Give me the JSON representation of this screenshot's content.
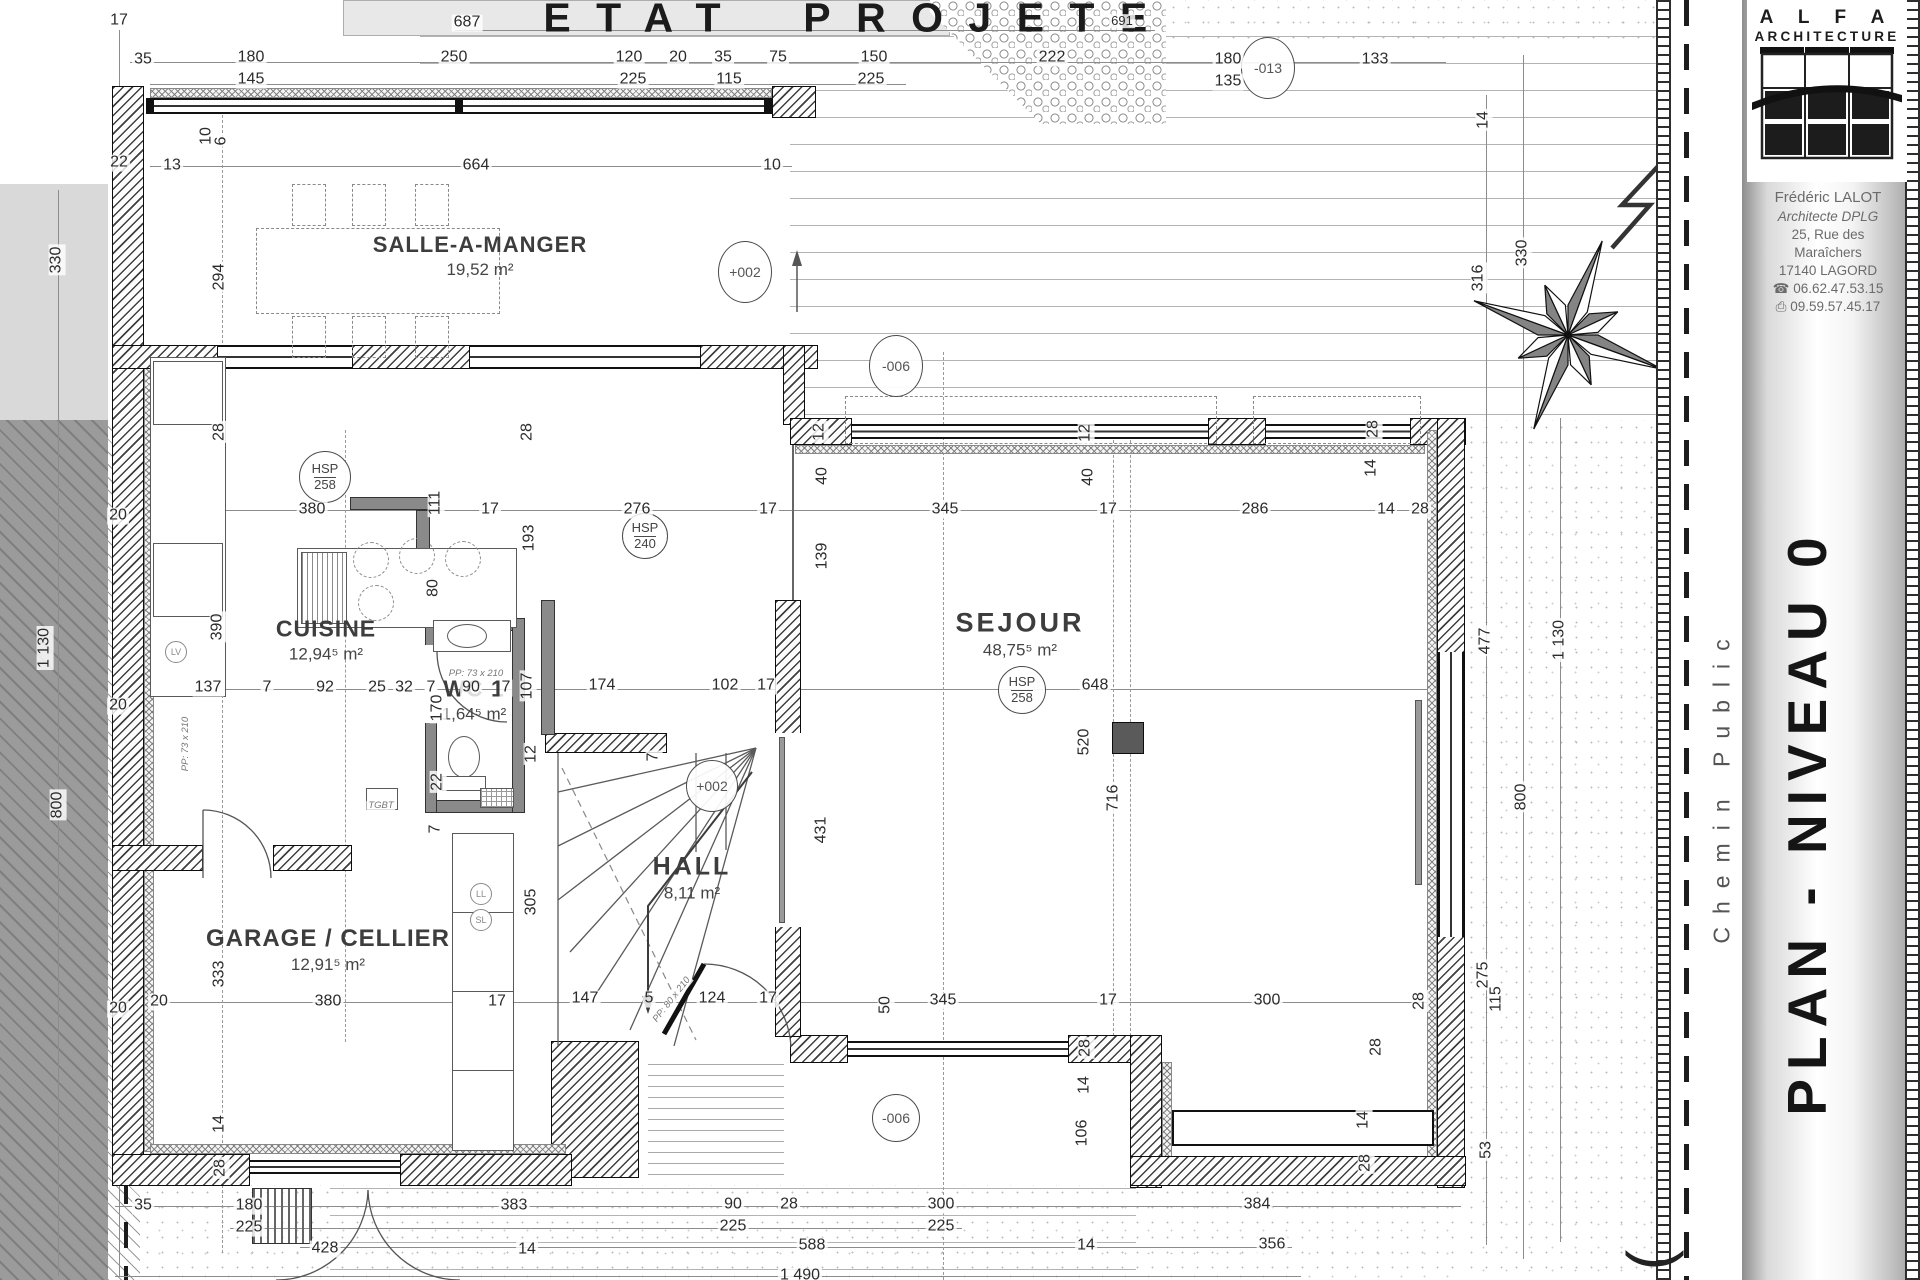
{
  "title": "ETAT PROJETE",
  "sidebar": {
    "brand_top": "A L F A",
    "brand_bottom": "ARCHITECTURE",
    "architect": "Frédéric LALOT",
    "credential": "Architecte DPLG",
    "address_line1": "25, Rue des",
    "address_line2": "Maraîchers",
    "address_line3": "17140 LAGORD",
    "phone": "06.62.47.53.15",
    "fax": "09.59.57.45.17",
    "icons": {
      "phone": "☎",
      "fax": "⎙"
    },
    "plan_title": "PLAN - NIVEAU 0",
    "street_label": "Chemin Public",
    "corner_glyph": "("
  },
  "rooms": [
    {
      "name": "SALLE-A-MANGER",
      "area": "19,52 m²",
      "cx": 480,
      "cy": 256
    },
    {
      "name": "CUISINE",
      "area": "12,94⁵ m²",
      "cx": 326,
      "cy": 640
    },
    {
      "name": "WC 1",
      "area": "1,64⁵ m²",
      "cx": 474,
      "cy": 700
    },
    {
      "name": "HALL",
      "area": "8,11 m²",
      "cx": 692,
      "cy": 878
    },
    {
      "name": "SEJOUR",
      "area": "48,75⁵ m²",
      "cx": 1020,
      "cy": 634
    },
    {
      "name": "GARAGE / CELLIER",
      "area": "12,91⁵ m²",
      "cx": 328,
      "cy": 950
    }
  ],
  "markers": [
    {
      "kind": "level",
      "label": "+002",
      "x": 745,
      "y": 272,
      "w": 52,
      "h": 60
    },
    {
      "kind": "level",
      "label": "+002",
      "x": 712,
      "y": 786,
      "w": 50,
      "h": 50
    },
    {
      "kind": "level",
      "label": "-006",
      "x": 896,
      "y": 366,
      "w": 52,
      "h": 60
    },
    {
      "kind": "level",
      "label": "-006",
      "x": 896,
      "y": 1118,
      "w": 46,
      "h": 46
    },
    {
      "kind": "level",
      "label": "-013",
      "x": 1268,
      "y": 68,
      "w": 52,
      "h": 60
    },
    {
      "kind": "hsp",
      "top": "HSP",
      "bottom": "258",
      "x": 325,
      "y": 477,
      "d": 50
    },
    {
      "kind": "hsp",
      "top": "HSP",
      "bottom": "240",
      "x": 645,
      "y": 536,
      "d": 44
    },
    {
      "kind": "hsp",
      "top": "HSP",
      "bottom": "258",
      "x": 1022,
      "y": 690,
      "d": 46
    },
    {
      "kind": "mini",
      "label": "LL",
      "x": 481,
      "y": 894,
      "d": 20
    },
    {
      "kind": "mini",
      "label": "SL",
      "x": 481,
      "y": 920,
      "d": 20
    },
    {
      "kind": "mini",
      "label": "LV",
      "x": 176,
      "y": 652,
      "d": 20
    }
  ],
  "annotations": [
    {
      "t": "17",
      "x": 119,
      "y": 21
    },
    {
      "t": "687",
      "x": 467,
      "y": 23
    },
    {
      "t": "691",
      "x": 1122,
      "y": 21,
      "s": "s"
    },
    {
      "t": "35",
      "x": 143,
      "y": 60
    },
    {
      "t": "180",
      "x": 251,
      "y": 58
    },
    {
      "t": "145",
      "x": 251,
      "y": 80
    },
    {
      "t": "250",
      "x": 454,
      "y": 58
    },
    {
      "t": "120",
      "x": 629,
      "y": 58
    },
    {
      "t": "225",
      "x": 633,
      "y": 80
    },
    {
      "t": "20",
      "x": 678,
      "y": 58
    },
    {
      "t": "35",
      "x": 723,
      "y": 58
    },
    {
      "t": "115",
      "x": 729,
      "y": 80
    },
    {
      "t": "75",
      "x": 778,
      "y": 58
    },
    {
      "t": "150",
      "x": 874,
      "y": 58
    },
    {
      "t": "225",
      "x": 871,
      "y": 80
    },
    {
      "t": "222",
      "x": 1052,
      "y": 58
    },
    {
      "t": "180",
      "x": 1228,
      "y": 60
    },
    {
      "t": "135",
      "x": 1228,
      "y": 82
    },
    {
      "t": "133",
      "x": 1375,
      "y": 60
    },
    {
      "t": "22",
      "x": 119,
      "y": 163
    },
    {
      "t": "13",
      "x": 172,
      "y": 166
    },
    {
      "t": "664",
      "x": 476,
      "y": 166
    },
    {
      "t": "10",
      "x": 772,
      "y": 166
    },
    {
      "t": "10",
      "x": 207,
      "y": 136,
      "r": -90
    },
    {
      "t": "6",
      "x": 222,
      "y": 141,
      "r": -90
    },
    {
      "t": "294",
      "x": 220,
      "y": 277,
      "r": -90
    },
    {
      "t": "14",
      "x": 1484,
      "y": 120,
      "r": -90
    },
    {
      "t": "316",
      "x": 1479,
      "y": 278,
      "r": -90
    },
    {
      "t": "330",
      "x": 1523,
      "y": 253,
      "r": -90
    },
    {
      "t": "330",
      "x": 57,
      "y": 260,
      "r": -90
    },
    {
      "t": "28",
      "x": 220,
      "y": 432,
      "r": -90
    },
    {
      "t": "28",
      "x": 528,
      "y": 432,
      "r": -90
    },
    {
      "t": "12",
      "x": 820,
      "y": 432,
      "r": -90
    },
    {
      "t": "40",
      "x": 823,
      "y": 476,
      "r": -90
    },
    {
      "t": "12",
      "x": 1086,
      "y": 433,
      "r": -90
    },
    {
      "t": "40",
      "x": 1089,
      "y": 477,
      "r": -90
    },
    {
      "t": "28",
      "x": 1374,
      "y": 429,
      "r": -90
    },
    {
      "t": "14",
      "x": 1372,
      "y": 468,
      "r": -90
    },
    {
      "t": "380",
      "x": 312,
      "y": 510
    },
    {
      "t": "111",
      "x": 436,
      "y": 503,
      "r": -90
    },
    {
      "t": "17",
      "x": 490,
      "y": 510
    },
    {
      "t": "276",
      "x": 637,
      "y": 510
    },
    {
      "t": "193",
      "x": 530,
      "y": 538,
      "r": -90
    },
    {
      "t": "17",
      "x": 768,
      "y": 510
    },
    {
      "t": "345",
      "x": 945,
      "y": 510
    },
    {
      "t": "139",
      "x": 823,
      "y": 556,
      "r": -90
    },
    {
      "t": "17",
      "x": 1108,
      "y": 510
    },
    {
      "t": "286",
      "x": 1255,
      "y": 510
    },
    {
      "t": "14",
      "x": 1386,
      "y": 510
    },
    {
      "t": "28",
      "x": 1420,
      "y": 510
    },
    {
      "t": "390",
      "x": 218,
      "y": 627,
      "r": -90
    },
    {
      "t": "80",
      "x": 434,
      "y": 588,
      "r": -90
    },
    {
      "t": "137",
      "x": 208,
      "y": 688
    },
    {
      "t": "7",
      "x": 267,
      "y": 688
    },
    {
      "t": "92",
      "x": 325,
      "y": 688
    },
    {
      "t": "25",
      "x": 377,
      "y": 688
    },
    {
      "t": "32",
      "x": 404,
      "y": 688
    },
    {
      "t": "7",
      "x": 431,
      "y": 688
    },
    {
      "t": "90",
      "x": 471,
      "y": 688
    },
    {
      "t": "7",
      "x": 506,
      "y": 688
    },
    {
      "t": "107",
      "x": 528,
      "y": 686,
      "r": -90
    },
    {
      "t": "174",
      "x": 602,
      "y": 686
    },
    {
      "t": "102",
      "x": 725,
      "y": 686
    },
    {
      "t": "17",
      "x": 766,
      "y": 686
    },
    {
      "t": "170",
      "x": 438,
      "y": 708,
      "r": -90
    },
    {
      "t": "22",
      "x": 438,
      "y": 782,
      "r": -90
    },
    {
      "t": "7",
      "x": 436,
      "y": 829,
      "r": -90
    },
    {
      "t": "7",
      "x": 654,
      "y": 757,
      "r": -90
    },
    {
      "t": "648",
      "x": 1095,
      "y": 686
    },
    {
      "t": "520",
      "x": 1085,
      "y": 742,
      "r": -90
    },
    {
      "t": "431",
      "x": 822,
      "y": 830,
      "r": -90
    },
    {
      "t": "12",
      "x": 532,
      "y": 754,
      "r": -90
    },
    {
      "t": "305",
      "x": 532,
      "y": 902,
      "r": -90
    },
    {
      "t": "716",
      "x": 1114,
      "y": 798,
      "r": -90
    },
    {
      "t": "147",
      "x": 585,
      "y": 999
    },
    {
      "t": "5",
      "x": 649,
      "y": 999
    },
    {
      "t": "124",
      "x": 712,
      "y": 999
    },
    {
      "t": "17",
      "x": 768,
      "y": 999
    },
    {
      "t": "345",
      "x": 943,
      "y": 1001
    },
    {
      "t": "17",
      "x": 1108,
      "y": 1001
    },
    {
      "t": "300",
      "x": 1267,
      "y": 1001
    },
    {
      "t": "28",
      "x": 1420,
      "y": 1001,
      "r": -90
    },
    {
      "t": "50",
      "x": 886,
      "y": 1005,
      "r": -90
    },
    {
      "t": "477",
      "x": 1486,
      "y": 641,
      "r": -90
    },
    {
      "t": "1 130",
      "x": 1560,
      "y": 640,
      "r": -90
    },
    {
      "t": "800",
      "x": 1522,
      "y": 797,
      "r": -90
    },
    {
      "t": "1 130",
      "x": 45,
      "y": 648,
      "r": -90
    },
    {
      "t": "800",
      "x": 58,
      "y": 805,
      "r": -90
    },
    {
      "t": "20",
      "x": 118,
      "y": 516
    },
    {
      "t": "20",
      "x": 118,
      "y": 706
    },
    {
      "t": "20",
      "x": 118,
      "y": 1009
    },
    {
      "t": "275",
      "x": 1484,
      "y": 975,
      "r": -90
    },
    {
      "t": "115",
      "x": 1497,
      "y": 999,
      "r": -90
    },
    {
      "t": "53",
      "x": 1487,
      "y": 1150,
      "r": -90
    },
    {
      "t": "20",
      "x": 159,
      "y": 1002
    },
    {
      "t": "333",
      "x": 220,
      "y": 974,
      "r": -90
    },
    {
      "t": "380",
      "x": 328,
      "y": 1002
    },
    {
      "t": "17",
      "x": 497,
      "y": 1002
    },
    {
      "t": "14",
      "x": 220,
      "y": 1124,
      "r": -90
    },
    {
      "t": "28",
      "x": 221,
      "y": 1168,
      "r": -90
    },
    {
      "t": "35",
      "x": 143,
      "y": 1206
    },
    {
      "t": "180",
      "x": 249,
      "y": 1206
    },
    {
      "t": "225",
      "x": 249,
      "y": 1228
    },
    {
      "t": "428",
      "x": 325,
      "y": 1249
    },
    {
      "t": "383",
      "x": 514,
      "y": 1206
    },
    {
      "t": "14",
      "x": 527,
      "y": 1250
    },
    {
      "t": "90",
      "x": 733,
      "y": 1205
    },
    {
      "t": "225",
      "x": 733,
      "y": 1227
    },
    {
      "t": "28",
      "x": 789,
      "y": 1205
    },
    {
      "t": "300",
      "x": 941,
      "y": 1205
    },
    {
      "t": "225",
      "x": 941,
      "y": 1227
    },
    {
      "t": "588",
      "x": 812,
      "y": 1246
    },
    {
      "t": "14",
      "x": 1086,
      "y": 1246
    },
    {
      "t": "384",
      "x": 1257,
      "y": 1205
    },
    {
      "t": "356",
      "x": 1272,
      "y": 1245
    },
    {
      "t": "28",
      "x": 1086,
      "y": 1048,
      "r": -90
    },
    {
      "t": "14",
      "x": 1085,
      "y": 1085,
      "r": -90
    },
    {
      "t": "106",
      "x": 1083,
      "y": 1133,
      "r": -90
    },
    {
      "t": "14",
      "x": 1364,
      "y": 1120,
      "r": -90
    },
    {
      "t": "28",
      "x": 1366,
      "y": 1163,
      "r": -90
    },
    {
      "t": "28",
      "x": 1377,
      "y": 1047,
      "r": -90
    },
    {
      "t": "1 490",
      "x": 800,
      "y": 1276
    },
    {
      "t": "PP: 73 x 210",
      "x": 476,
      "y": 674,
      "s": "t"
    },
    {
      "t": "PP: 73 x 210",
      "x": 186,
      "y": 744,
      "r": -90,
      "s": "t"
    },
    {
      "t": "PP: 80 x 210",
      "x": 672,
      "y": 1000,
      "r": -52,
      "s": "t"
    },
    {
      "t": "TGBT",
      "x": 381,
      "y": 806,
      "s": "t"
    }
  ],
  "colors": {
    "wall": "#1a1a1a",
    "dim_text": "#2b2b2b",
    "road_gray": "#9b9b9b",
    "deck_line": "#b3b3b3"
  }
}
